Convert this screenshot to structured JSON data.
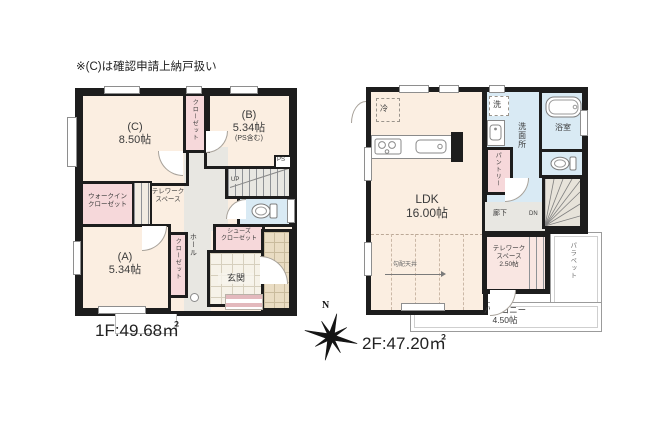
{
  "note": "※(C)は確認申請上納戸扱い",
  "compass": {
    "north": "N"
  },
  "floor1": {
    "area_label": "1F:49.68㎡",
    "room_c": {
      "name": "(C)",
      "size": "8.50帖"
    },
    "room_b": {
      "name": "(B)",
      "size": "5.34帖",
      "note": "(PS含む)"
    },
    "room_a": {
      "name": "(A)",
      "size": "5.34帖"
    },
    "closet_top": "クローゼット",
    "closet_a": "クローゼット",
    "walkin_closet": {
      "line1": "ウォークイン",
      "line2": "クローゼット"
    },
    "telework": {
      "line1": "テレワーク",
      "line2": "スペース"
    },
    "hall": "ホール",
    "shoes_closet": {
      "line1": "シューズ",
      "line2": "クローゼット"
    },
    "entrance": "玄関",
    "stairs_label": "UP",
    "ps_label": "PS"
  },
  "floor2": {
    "area_label": "2F:47.20㎡",
    "ldk": {
      "name": "LDK",
      "size": "16.00帖"
    },
    "fridge": "冷",
    "washer": "洗",
    "washroom": "洗面所",
    "bathroom": "浴室",
    "pantry": "パントリー",
    "corridor": "廊下",
    "stairs_label": "DN",
    "telework": {
      "line1": "テレワーク",
      "line2": "スペース",
      "size": "2.50帖"
    },
    "balcony": {
      "name": "バルコニー",
      "size": "4.50帖"
    },
    "parapet": "パラペット",
    "sloped_ceiling": "勾配天井"
  },
  "colors": {
    "wall": "#1d1d1d",
    "room_cream": "#fbeee1",
    "closet_pink": "#f6d8da",
    "wet_blue": "#d9eaf4",
    "hall_gray": "#e8e7e2",
    "tile_beige": "#e9dcc3"
  }
}
